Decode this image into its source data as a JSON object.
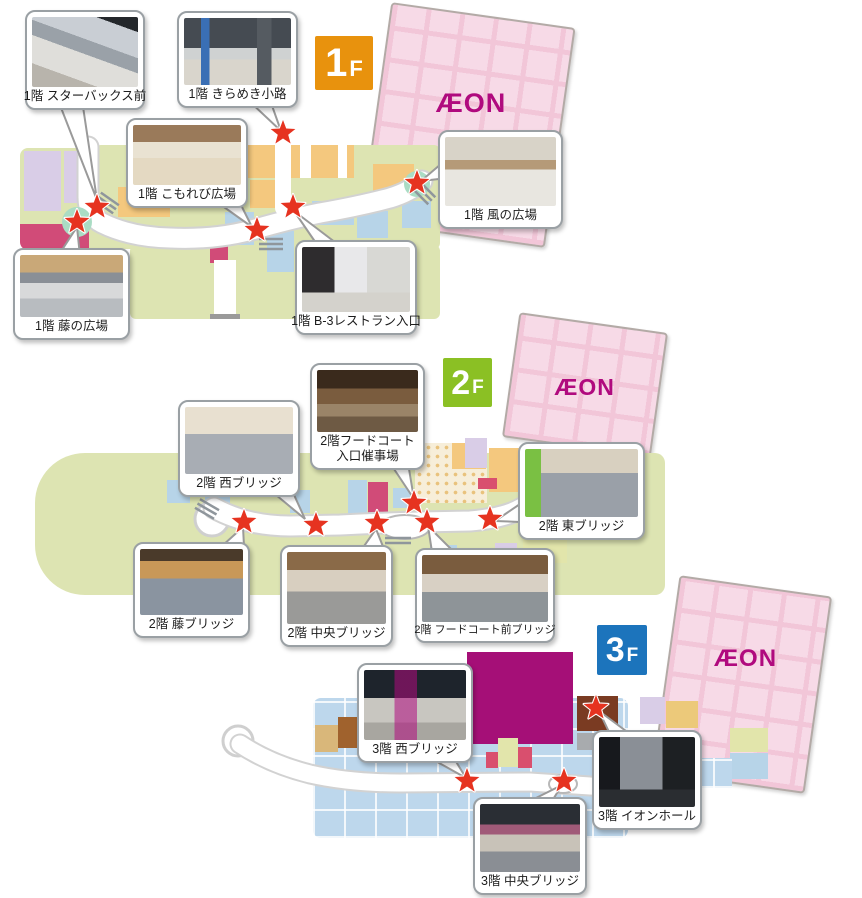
{
  "aeon": {
    "logo": "ÆON"
  },
  "colors": {
    "badge_1f": "#E8920D",
    "badge_2f": "#8BC024",
    "badge_3f": "#1C74BC",
    "star_red": "#E63320",
    "aeon_magenta": "#B00A7E",
    "aeon_pink": "#F7DAE7"
  },
  "floors": [
    {
      "name": "1F",
      "badge": {
        "number": "1",
        "suffix": "F"
      },
      "callouts": [
        {
          "id": "1f-starbucks",
          "label": "1階 スターバックス前"
        },
        {
          "id": "1f-kirameki",
          "label": "1階 きらめき小路"
        },
        {
          "id": "1f-komorebi",
          "label": "1階 こもれび広場"
        },
        {
          "id": "1f-kaze",
          "label": "1階 風の広場"
        },
        {
          "id": "1f-fuji",
          "label": "1階 藤の広場"
        },
        {
          "id": "1f-b3",
          "label": "1階  B-3レストラン入口"
        }
      ],
      "stars": [
        [
          97,
          207
        ],
        [
          77,
          222
        ],
        [
          283,
          133
        ],
        [
          257,
          230
        ],
        [
          293,
          207
        ],
        [
          417,
          183
        ]
      ]
    },
    {
      "name": "2F",
      "badge": {
        "number": "2",
        "suffix": "F"
      },
      "callouts": [
        {
          "id": "2f-iriguchi",
          "label": "2階フードコート入口催事場",
          "label_lines": [
            "2階フードコート",
            "入口催事場"
          ]
        },
        {
          "id": "2f-nishi",
          "label": "2階 西ブリッジ"
        },
        {
          "id": "2f-higashi",
          "label": "2階 東ブリッジ"
        },
        {
          "id": "2f-fuji",
          "label": "2階 藤ブリッジ"
        },
        {
          "id": "2f-chuo",
          "label": "2階 中央ブリッジ"
        },
        {
          "id": "2f-fcmae",
          "label": "2階 フードコート前ブリッジ"
        }
      ],
      "stars": [
        [
          244,
          522
        ],
        [
          316,
          525
        ],
        [
          377,
          523
        ],
        [
          414,
          503
        ],
        [
          427,
          522
        ],
        [
          490,
          519
        ]
      ]
    },
    {
      "name": "3F",
      "badge": {
        "number": "3",
        "suffix": "F"
      },
      "callouts": [
        {
          "id": "3f-nishi",
          "label": "3階 西ブリッジ"
        },
        {
          "id": "3f-aeonhall",
          "label": "3階 イオンホール"
        },
        {
          "id": "3f-chuo",
          "label": "3階 中央ブリッジ"
        }
      ],
      "stars": [
        [
          596,
          708
        ],
        [
          467,
          781
        ],
        [
          564,
          781
        ]
      ]
    }
  ]
}
